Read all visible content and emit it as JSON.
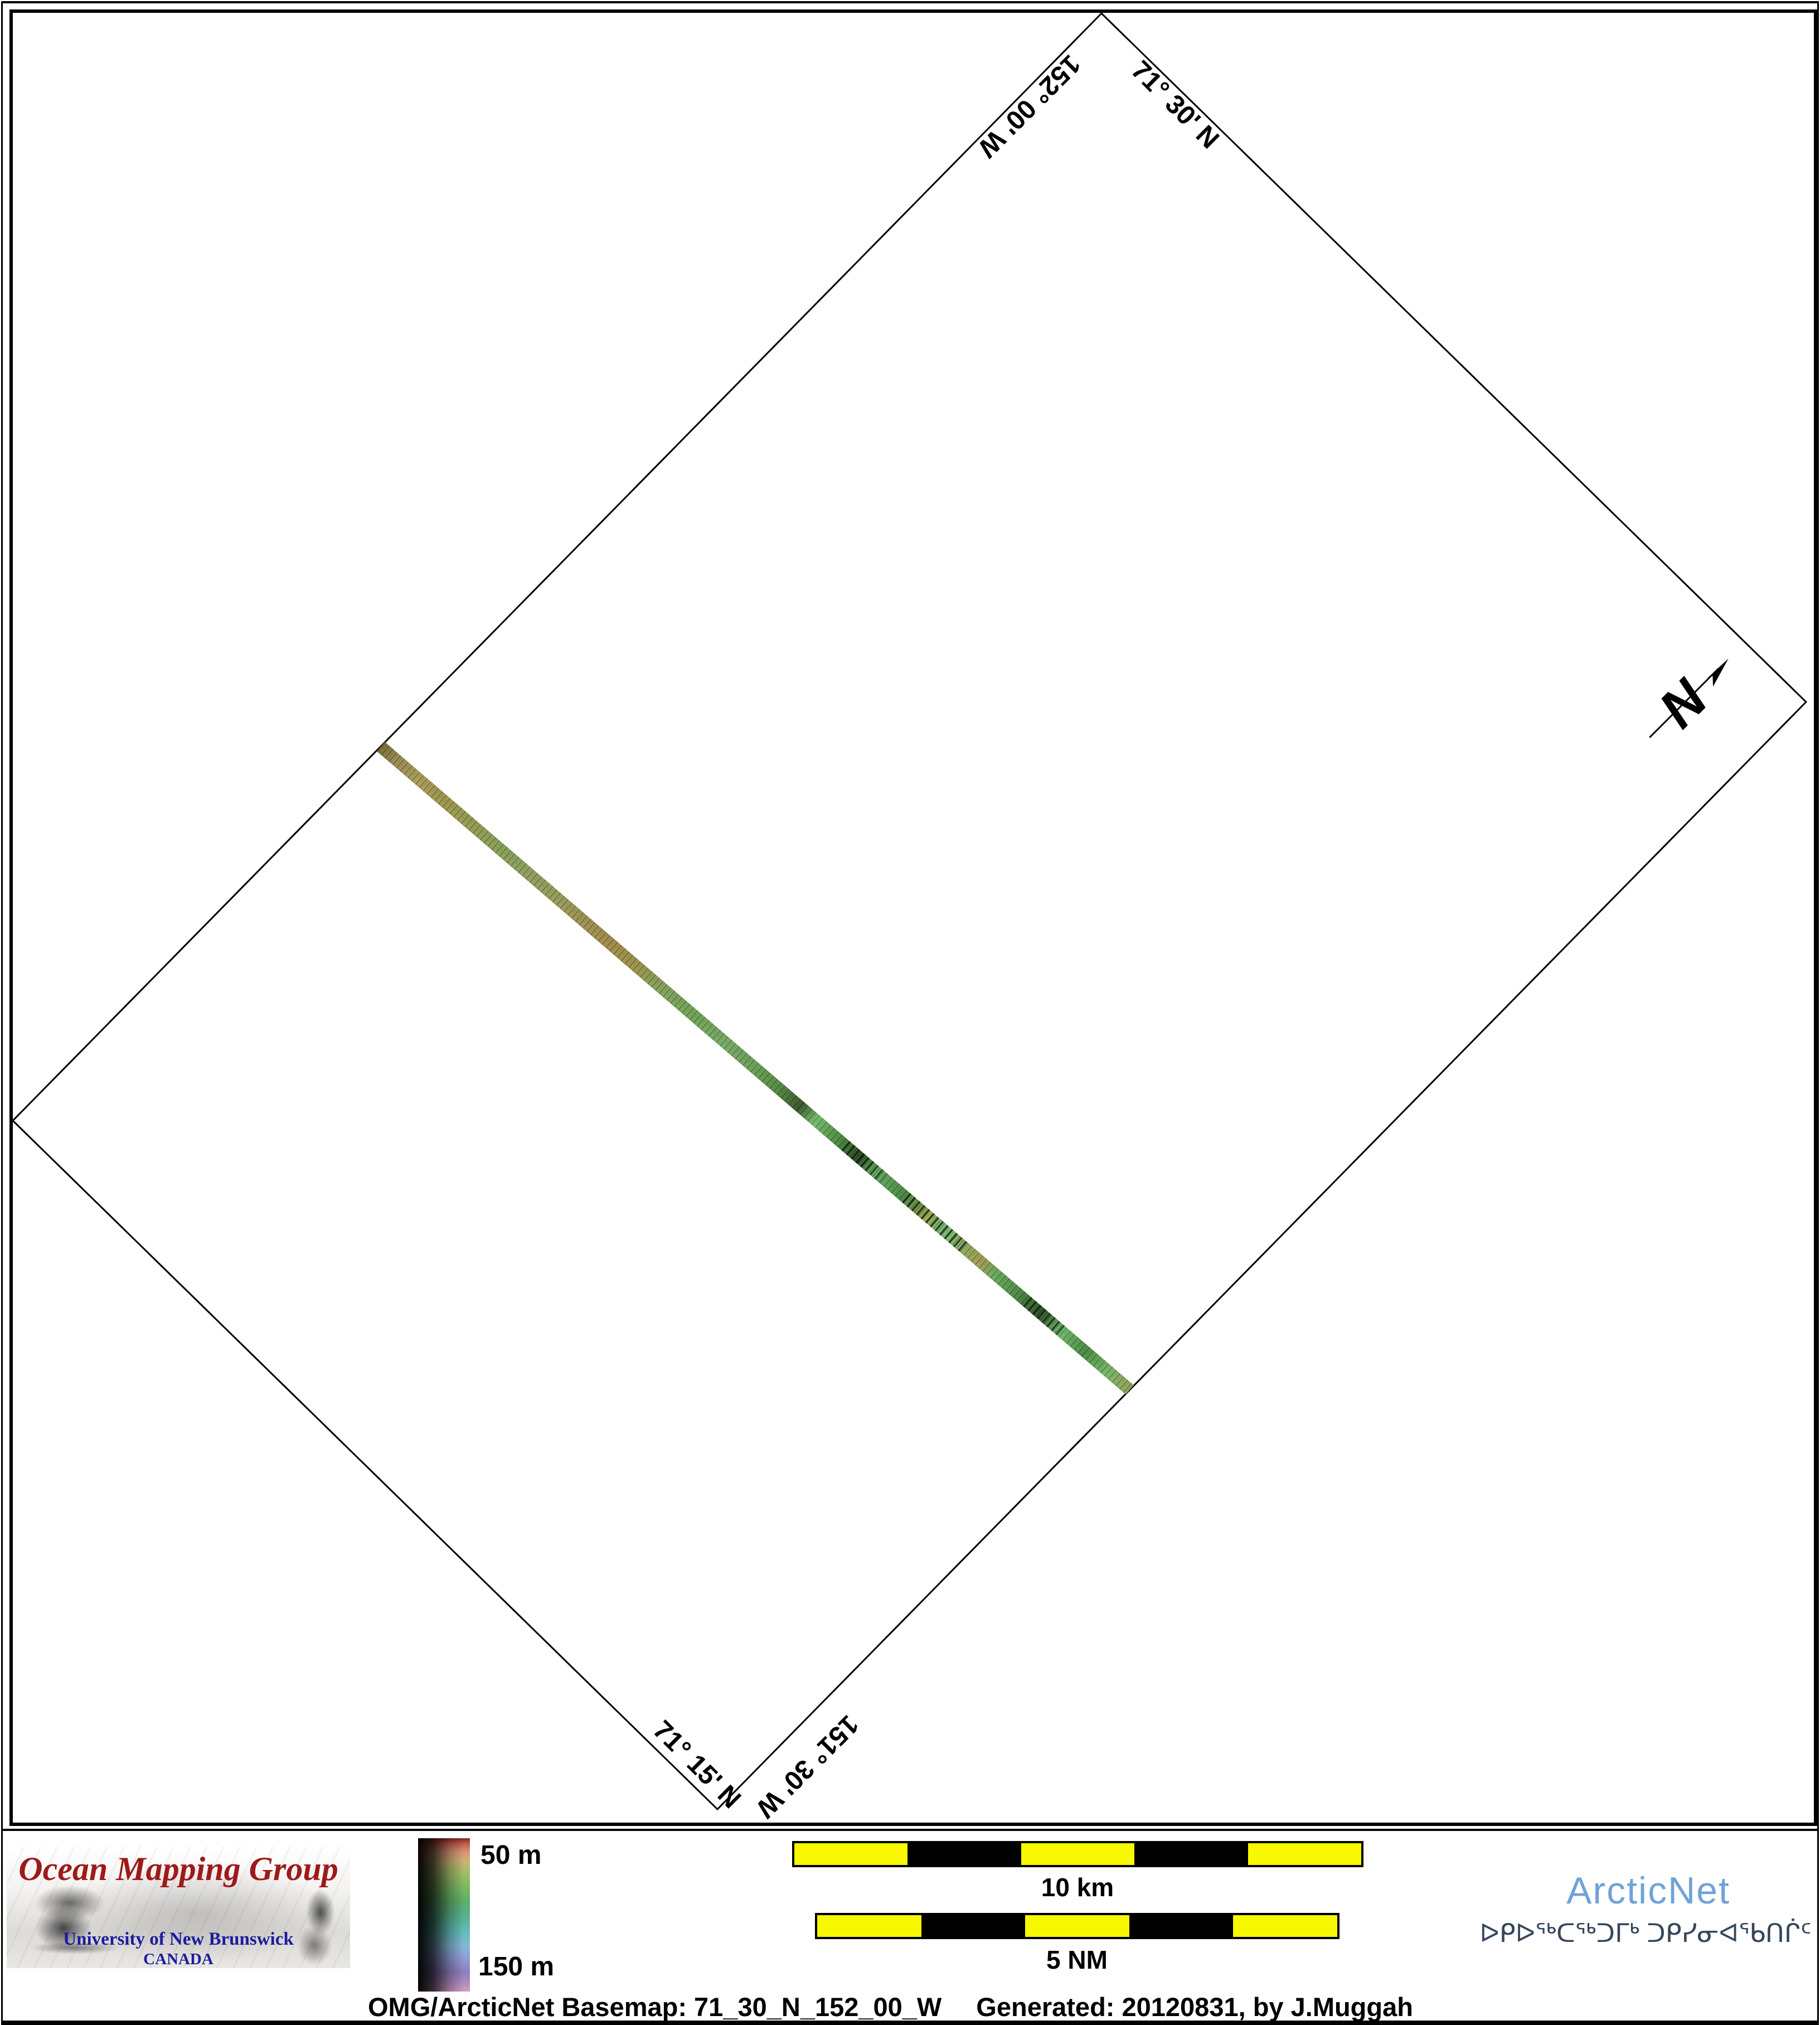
{
  "map": {
    "corner_labels": {
      "top_left_longitude": "152° 00' W",
      "top_right_latitude": "71° 30' N",
      "bottom_left_latitude": "71° 15' N",
      "bottom_right_longitude": "151° 30' W"
    },
    "north_arrow_label": "N",
    "frame_color": "#000000",
    "swath": {
      "description": "multibeam survey line crossing map diagonally",
      "colors_start_to_end": [
        "#9c8d55",
        "#a68f4e",
        "#74a65c",
        "#5c9049",
        "#7dbf74",
        "#a89f5b",
        "#54904a",
        "#7bb96d"
      ]
    }
  },
  "footer": {
    "omg_logo": {
      "title": "Ocean Mapping Group",
      "university": "University of New Brunswick",
      "country": "CANADA",
      "title_color": "#9e1a1a",
      "text_color": "#1b1b9e"
    },
    "colorbar": {
      "top_label": "50 m",
      "bottom_label": "150 m"
    },
    "scalebars": {
      "km_label": "10 km",
      "nm_label": "5 NM",
      "segment_yellow": "#f8f800",
      "segment_black": "#000000"
    },
    "arcticnet": {
      "name": "ArcticNet",
      "inuktitut": "ᐅᑭᐅᖅᑕᖅᑐᒥᒃ ᑐᑭᓯᓂᐊᖃᑎᒌᑦ",
      "name_color": "#6fa3d8",
      "inuktitut_color": "#35465c"
    },
    "caption": {
      "left": "OMG/ArcticNet Basemap: 71_30_N_152_00_W",
      "right": "Generated: 20120831, by J.Muggah"
    }
  }
}
